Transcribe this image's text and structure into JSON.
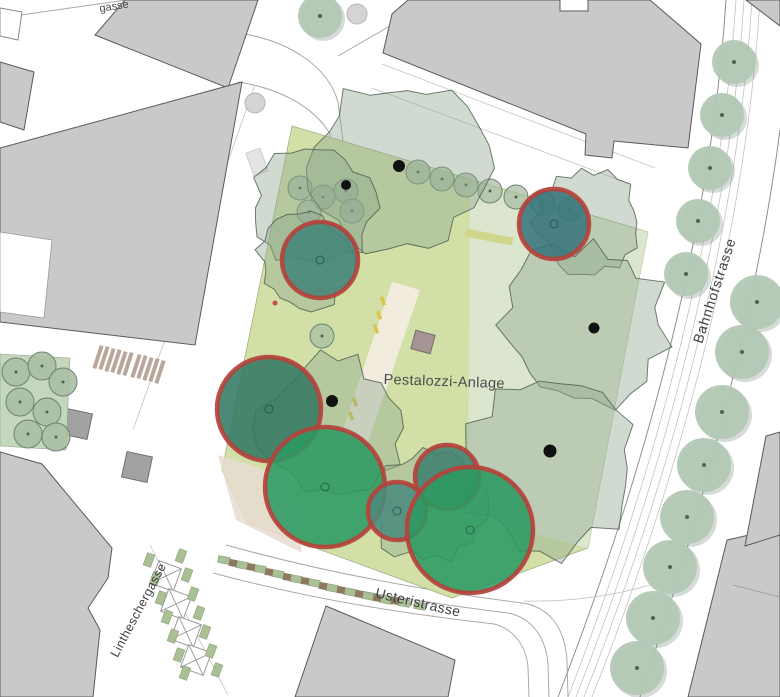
{
  "labels": {
    "park": "Pestalozzi-Anlage",
    "bahnhofstrasse": "Bahnhofstrasse",
    "usteristrasse": "Usteristrasse",
    "lintheschergasse": "Lintheschergasse",
    "gasse_partial": "gasse"
  },
  "map": {
    "colors": {
      "park_fill": "#d2e0a8",
      "park_right_band": "#dde7d2",
      "park_pink_zone": "#e9dcd2",
      "path_cream": "#f2ecdf",
      "canopy_fill": "#8fa78f",
      "canopy_stroke": "#4e5c4e",
      "small_tree_fill": "#aabfa4",
      "small_tree_stroke": "#6c8570",
      "street_tree_fill": "#b3c8b5",
      "street_tree_shadow": "#78887a",
      "tree_dot": "#4f6355",
      "trunk_dot": "#111111",
      "highlight_stroke": "#b4423c",
      "bench_yellow": "#d9c64e",
      "hedge_yellow_green": "#d2d68c",
      "monument_fill": "#a59494",
      "stall_green": "#a9bf94",
      "stall_brown": "#8d7862",
      "stall_x_stroke": "#9a9a9a",
      "hatch_brown": "#b9a79b",
      "building_gray": "#c9c9c9",
      "plaza_circle": "#d4d4d4"
    },
    "highlighted_trees": [
      {
        "id": "tree-1",
        "x": 320,
        "y": 260,
        "r": 38,
        "color": "#418579"
      },
      {
        "id": "tree-2",
        "x": 554,
        "y": 224,
        "r": 35,
        "color": "#36747c"
      },
      {
        "id": "tree-3",
        "x": 269,
        "y": 409,
        "r": 52,
        "color": "#337763"
      },
      {
        "id": "tree-4",
        "x": 325,
        "y": 487,
        "r": 60,
        "color": "#2b9a62"
      },
      {
        "id": "tree-5",
        "x": 447,
        "y": 477,
        "r": 32,
        "color": "#3d7f6f"
      },
      {
        "id": "tree-6",
        "x": 397,
        "y": 511,
        "r": 29,
        "color": "#4a8b7e"
      },
      {
        "id": "tree-7",
        "x": 470,
        "y": 530,
        "r": 63,
        "color": "#2b9a62"
      }
    ],
    "canopies": [
      {
        "x": 398,
        "y": 168,
        "r": 95,
        "seed": 7
      },
      {
        "x": 312,
        "y": 208,
        "r": 66,
        "seed": 3
      },
      {
        "x": 305,
        "y": 262,
        "r": 50,
        "seed": 11
      },
      {
        "x": 588,
        "y": 222,
        "r": 55,
        "seed": 5
      },
      {
        "x": 583,
        "y": 325,
        "r": 88,
        "seed": 13
      },
      {
        "x": 550,
        "y": 468,
        "r": 92,
        "seed": 17
      },
      {
        "x": 330,
        "y": 428,
        "r": 76,
        "seed": 19
      },
      {
        "x": 430,
        "y": 505,
        "r": 62,
        "seed": 23
      }
    ],
    "trunk_dots": [
      [
        346,
        185,
        5
      ],
      [
        399,
        166,
        6
      ],
      [
        332,
        401,
        6
      ],
      [
        550,
        451,
        6.5
      ],
      [
        594,
        328,
        5.5
      ]
    ],
    "park_small_trees": [
      [
        300,
        188
      ],
      [
        323,
        197
      ],
      [
        346,
        191
      ],
      [
        309,
        212
      ],
      [
        352,
        211
      ],
      [
        418,
        172
      ],
      [
        442,
        179
      ],
      [
        466,
        185
      ],
      [
        490,
        191
      ],
      [
        516,
        197
      ],
      [
        543,
        203
      ],
      [
        570,
        209
      ],
      [
        322,
        336
      ]
    ],
    "courtyard_trees": [
      [
        16,
        372
      ],
      [
        42,
        366
      ],
      [
        63,
        382
      ],
      [
        20,
        402
      ],
      [
        47,
        412
      ],
      [
        28,
        434
      ],
      [
        56,
        437
      ]
    ],
    "street_trees_east": [
      [
        757,
        302
      ],
      [
        742,
        352
      ],
      [
        722,
        412
      ],
      [
        704,
        465
      ],
      [
        687,
        517
      ],
      [
        670,
        567
      ],
      [
        653,
        618
      ],
      [
        637,
        668
      ]
    ],
    "street_trees_west": [
      [
        734,
        62
      ],
      [
        722,
        115
      ],
      [
        710,
        168
      ],
      [
        698,
        221
      ],
      [
        686,
        274
      ]
    ],
    "top_tree": [
      320,
      16
    ],
    "plaza_circles": [
      [
        357,
        14
      ],
      [
        255,
        103
      ]
    ],
    "market_x_stalls": [
      [
        166,
        576
      ],
      [
        176,
        604
      ],
      [
        186,
        632
      ],
      [
        196,
        660
      ]
    ],
    "planters_left": [
      [
        149,
        560
      ],
      [
        155,
        579
      ],
      [
        161,
        598
      ],
      [
        167,
        617
      ],
      [
        173,
        636
      ],
      [
        179,
        655
      ],
      [
        185,
        673
      ]
    ],
    "planters_right": [
      [
        181,
        556
      ],
      [
        187,
        575
      ],
      [
        193,
        594
      ],
      [
        199,
        613
      ],
      [
        205,
        632
      ],
      [
        211,
        651
      ],
      [
        217,
        670
      ]
    ],
    "row_green": [
      [
        224,
        560
      ],
      [
        242,
        565
      ],
      [
        260,
        569
      ],
      [
        278,
        574
      ],
      [
        296,
        579
      ],
      [
        314,
        583
      ],
      [
        332,
        588
      ],
      [
        350,
        592
      ],
      [
        368,
        596
      ],
      [
        386,
        600
      ],
      [
        404,
        603
      ],
      [
        420,
        606
      ]
    ],
    "row_brown": [
      [
        233,
        563
      ],
      [
        251,
        567
      ],
      [
        269,
        572
      ],
      [
        287,
        577
      ],
      [
        305,
        581
      ],
      [
        323,
        586
      ],
      [
        341,
        590
      ],
      [
        359,
        594
      ],
      [
        377,
        598
      ],
      [
        395,
        601
      ]
    ],
    "hatch_bars": [
      [
        98,
        357
      ],
      [
        104,
        358
      ],
      [
        110,
        360
      ],
      [
        116,
        361
      ],
      [
        122,
        363
      ],
      [
        128,
        364
      ],
      [
        136,
        366
      ],
      [
        142,
        367
      ],
      [
        148,
        369
      ],
      [
        154,
        370
      ],
      [
        160,
        372
      ]
    ],
    "benches": [
      [
        383,
        301
      ],
      [
        379,
        315
      ],
      [
        376,
        329
      ],
      [
        355,
        402
      ],
      [
        351,
        416
      ]
    ],
    "poi_red_dot": [
      275,
      303
    ]
  }
}
